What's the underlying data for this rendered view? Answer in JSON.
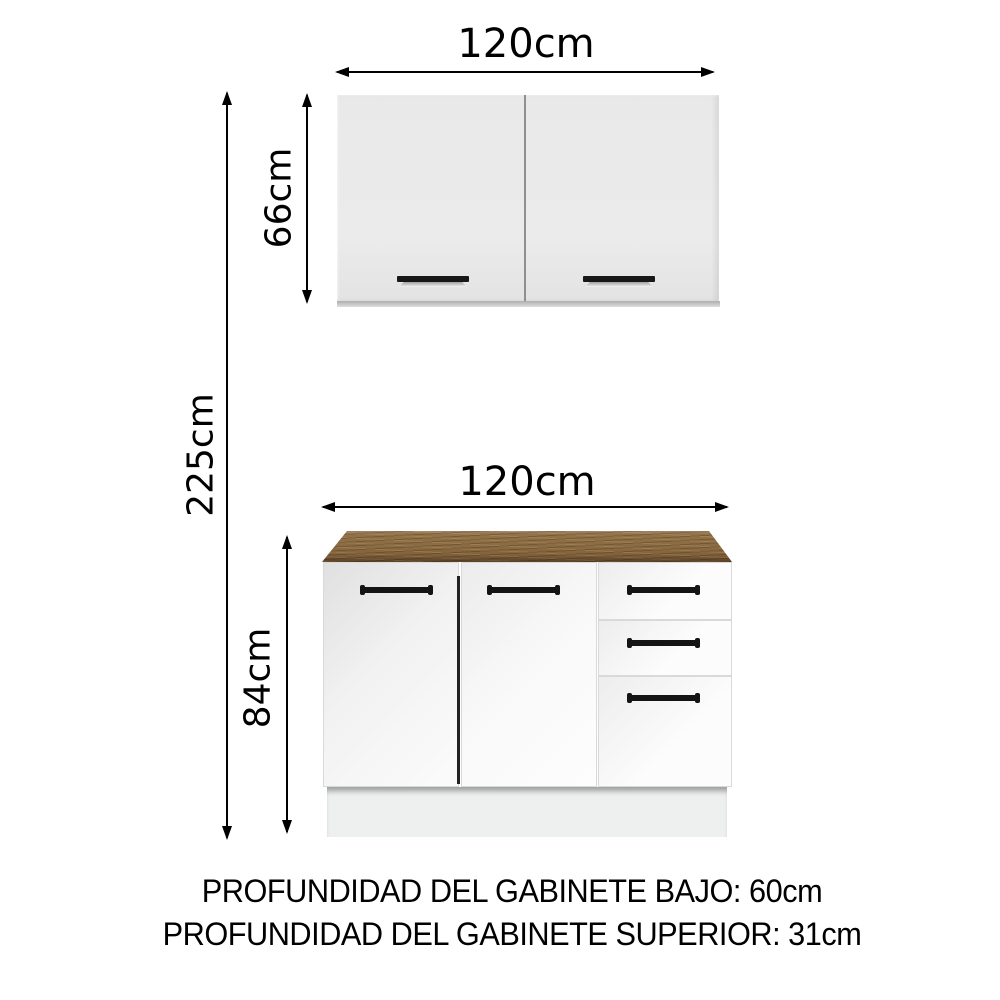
{
  "diagram": {
    "title": "kitchen-cabinet-dimension-diagram",
    "total_height_label": "225cm",
    "upper_cabinet": {
      "width_label": "120cm",
      "height_label": "66cm",
      "doors": 2
    },
    "lower_cabinet": {
      "width_label": "120cm",
      "height_label": "84cm",
      "doors": 2,
      "drawers": 3
    },
    "footer": {
      "line1": "PROFUNDIDAD DEL GABINETE BAJO: 60cm",
      "line2": "PROFUNDIDAD DEL GABINETE SUPERIOR: 31cm"
    },
    "colors": {
      "background": "#ffffff",
      "arrow": "#000000",
      "upper_cabinet_body": "#e9e9e9",
      "lower_cabinet_body": "#fafafa",
      "countertop_wood": "#8a6a42",
      "handle": "#141414",
      "plinth": "#eef0ef"
    }
  }
}
